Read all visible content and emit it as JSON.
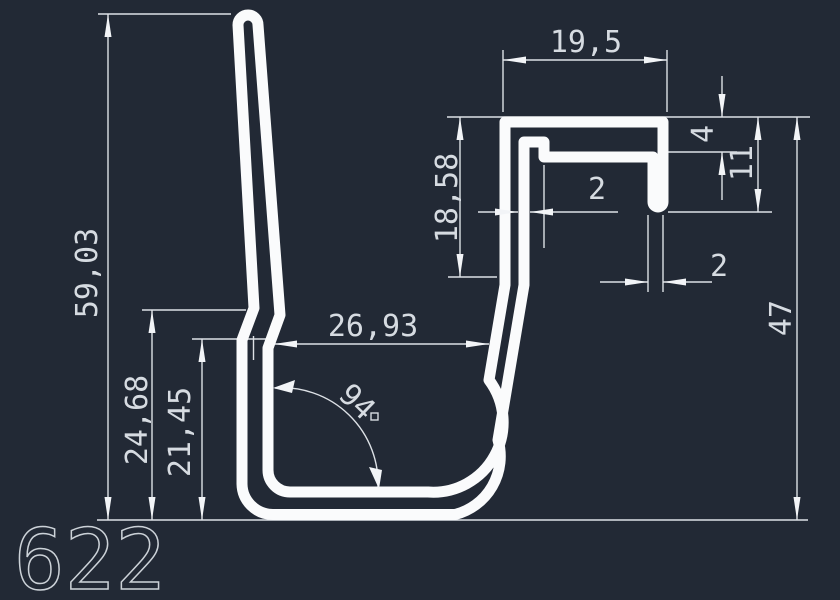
{
  "drawing": {
    "part_number": "622",
    "colors": {
      "background": "#222935",
      "profile_line": "#fafbfc",
      "dimension_line": "#dde1e6",
      "text": "#d6dbe1"
    },
    "dimensions": {
      "total_height": "59,03",
      "left_outer_height": "24,68",
      "left_inner_height": "21,45",
      "inner_width": "26,93",
      "angle_degrees": "94",
      "slot_depth": "18,58",
      "top_width": "19,5",
      "top_hook_offset": "4",
      "hook_depth": "11",
      "wall_thickness": "2",
      "lip_thickness": "2",
      "right_height": "47"
    }
  }
}
